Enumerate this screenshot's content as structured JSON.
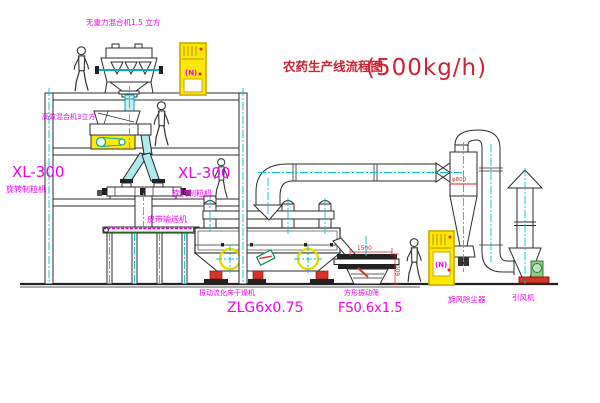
{
  "title": {
    "text": "农药生产线流程图",
    "capacity": "(500kg/h)"
  },
  "equipment_labels": {
    "gravity_mixer": "无重力混合机1.5 立方",
    "high_efficiency_mixer": "高效混合机3立方",
    "granulator_left": {
      "model": "XL-300",
      "name": "旋转制粒机"
    },
    "granulator_right": {
      "model": "XL-300",
      "name": "旋转制粒机"
    },
    "belt_conveyor": "皮带输送机",
    "fluid_bed_dryer": {
      "name": "振动流化床干燥机",
      "model": "ZLG6x0.75"
    },
    "vibrating_screen": {
      "name": "方形振动筛",
      "model": "FS0.6x1.5"
    },
    "cyclone_dust_collector": "旋风除尘器",
    "induced_draft_fan": "引风机"
  },
  "dimensions": {
    "screen_length": "1500",
    "screen_height": "600",
    "cyclone_diameter": "φ800"
  },
  "control_cabinet_text": "(N)",
  "colors": {
    "line": "#2b2b2b",
    "centerline": "#00c3c9",
    "label": "#ee00ee",
    "title": "#cc2233",
    "dimension": "#d42222",
    "highlight_yellow": "#ffe900",
    "chute_fill": "#aee9ef",
    "motor_green": "#8cc98c",
    "accent_red": "#d43326"
  }
}
